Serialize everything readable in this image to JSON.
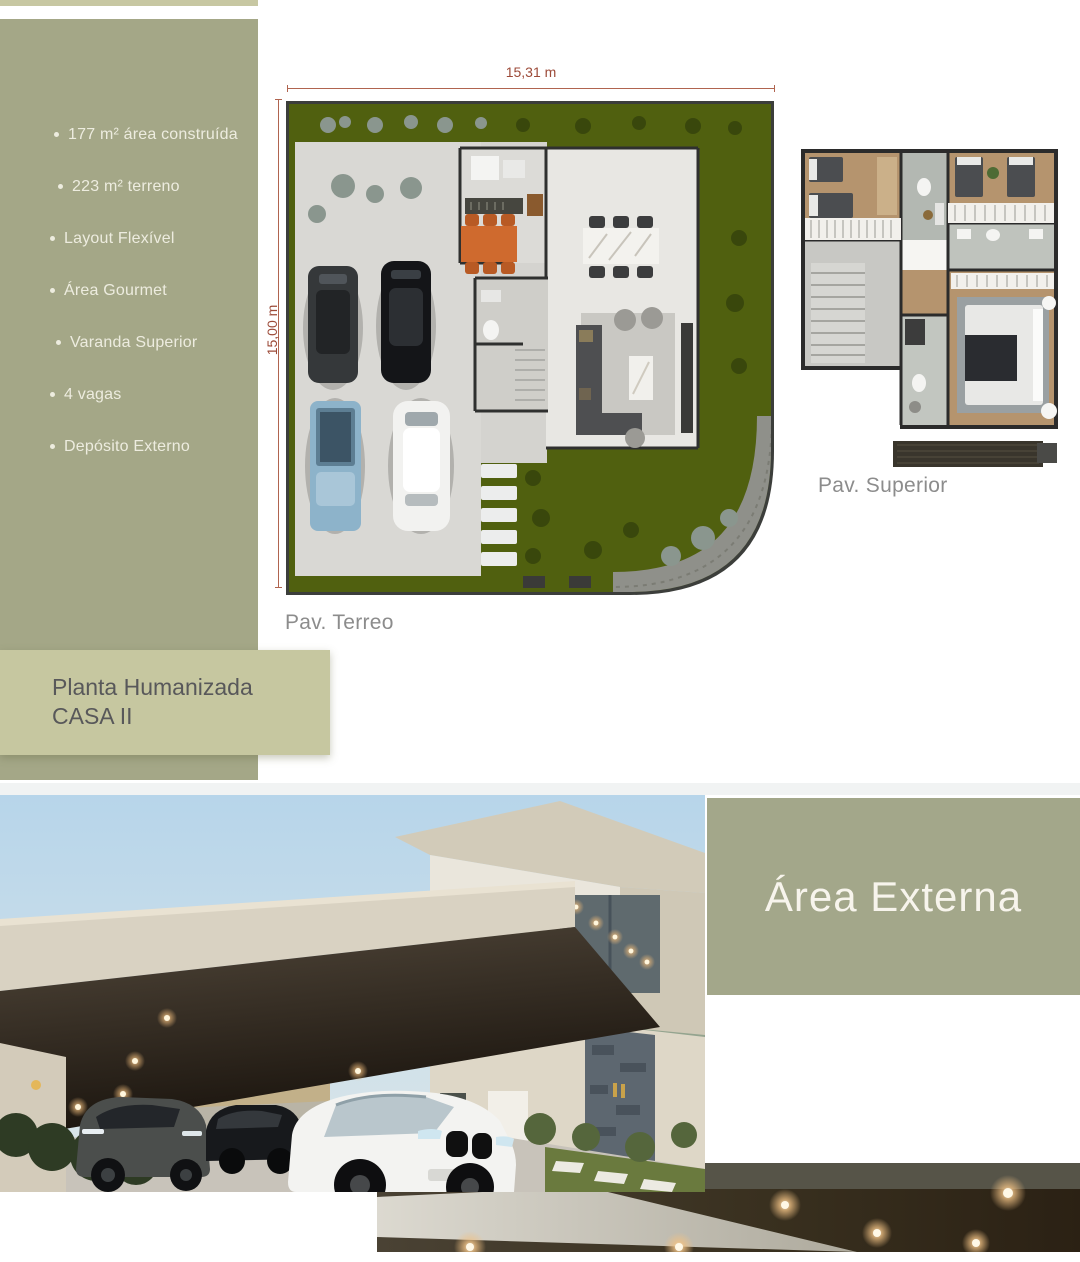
{
  "sidebar": {
    "features": [
      "177 m² área construída",
      "223 m² terreno",
      "Layout Flexível",
      "Área Gourmet",
      "Varanda Superior",
      "4 vagas",
      "Depósito Externo"
    ]
  },
  "floorplans": {
    "terreo": {
      "caption": "Pav. Terreo",
      "width_label": "15,31 m",
      "height_label": "15,00 m"
    },
    "superior": {
      "caption": "Pav. Superior"
    }
  },
  "title_box": {
    "line1": "Planta Humanizada",
    "line2": "CASA II"
  },
  "sections": {
    "external_title": "Área Externa"
  },
  "colors": {
    "sage": "#a4a787",
    "light_sage": "#c6c7a0",
    "panel_sage": "#a3a78a",
    "dimension_red": "#9c4a38",
    "caption_gray": "#8c8c8c",
    "title_text": "#58585a",
    "feature_text": "#edecdf",
    "lawn_green": "#50600f",
    "divider": "#f1f3f3"
  }
}
